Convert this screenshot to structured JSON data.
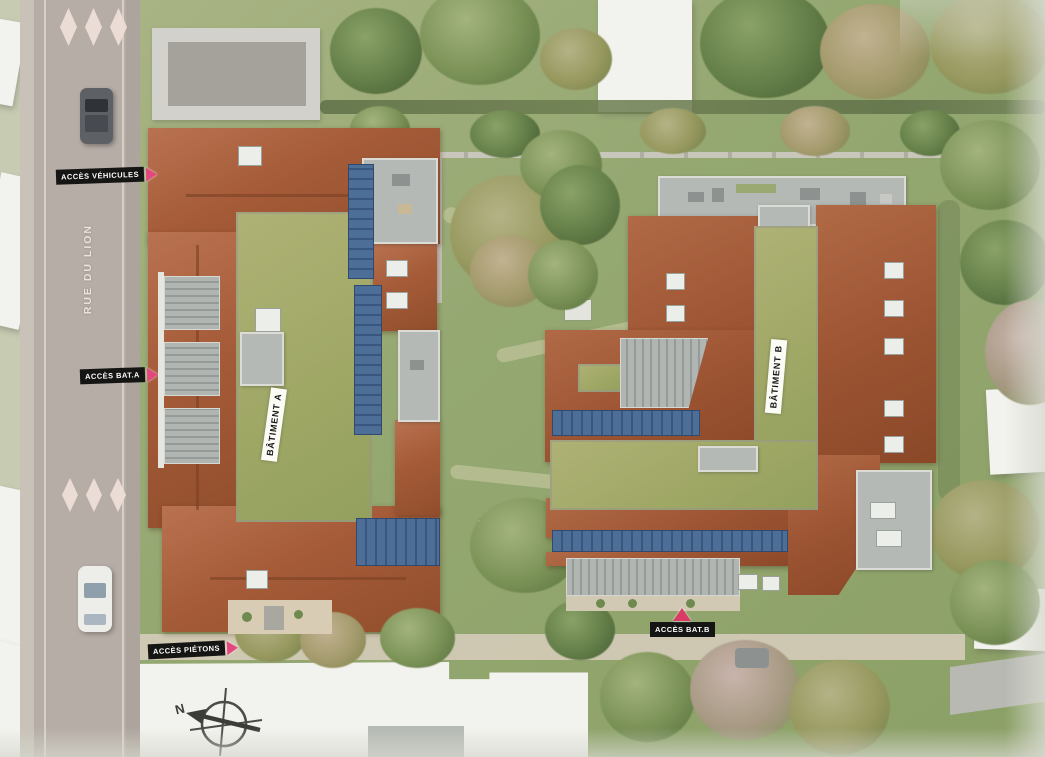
{
  "site_plan": {
    "street": {
      "name_label": "RUE DU LION"
    },
    "access_points": {
      "vehicles_label": "ACCÈS VÉHICULES",
      "building_a_label": "ACCÈS BAT.A",
      "pedestrians_label": "ACCÈS PIÉTONS",
      "building_b_label": "ACCÈS BAT.B"
    },
    "buildings": {
      "building_a_name": "BÂTIMENT A",
      "building_b_name": "BÂTIMENT B"
    },
    "compass": {
      "north_label": "N"
    },
    "icons": [
      "triangle-arrow-right-icon",
      "triangle-arrow-up-icon",
      "north-compass-icon",
      "car-icon",
      "crosswalk-diamond-icon"
    ],
    "colors": {
      "accent_arrow_pink": "#e2487e",
      "label_background": "#151514",
      "label_text": "#ffffff",
      "roof_terracotta": "#a55b38",
      "green_roof": "#9fa765",
      "solar_panel_blue": "#46648c",
      "road_gray": "#b6ada6",
      "grass_green": "#95a872",
      "terrace_gray": "#b5b9b5",
      "neighbor_building_white": "#f2f2ee"
    }
  }
}
